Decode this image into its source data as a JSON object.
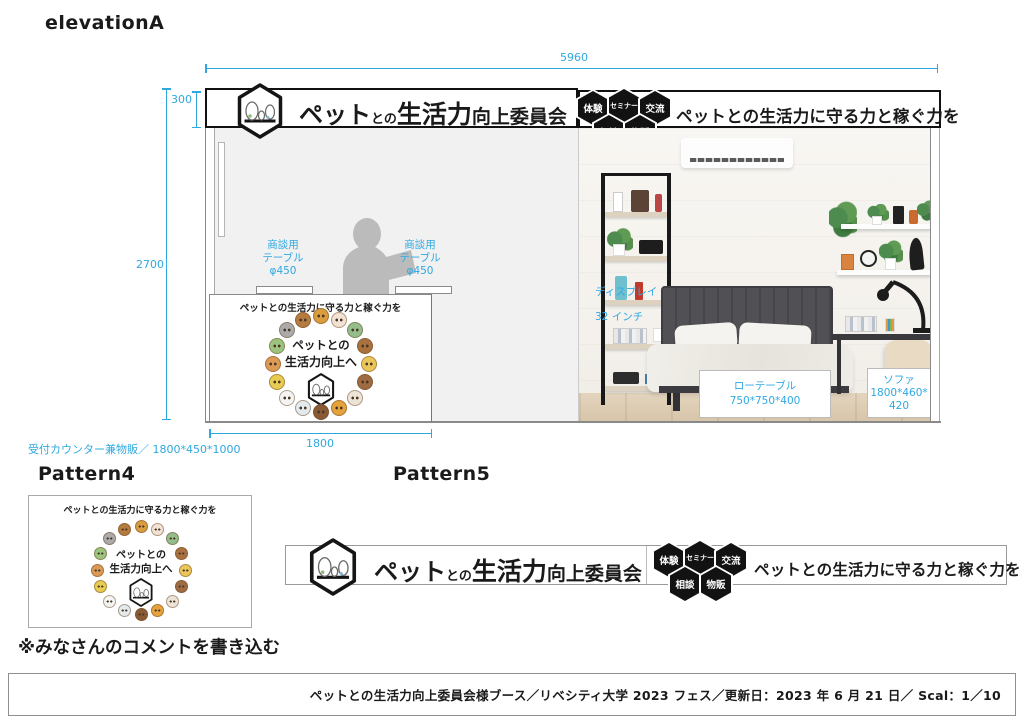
{
  "colors": {
    "dimension": "#2FA8E1",
    "wall": "#F1F1F2",
    "silhouette": "#BBBBBB",
    "badge_bg": "#121212"
  },
  "titles": {
    "elevation": "elevationA",
    "pattern4": "Pattern4",
    "pattern5": "Pattern5",
    "comment_note": "※みなさんのコメントを書き込む"
  },
  "dims": {
    "total_width": "5960",
    "total_height": "2700",
    "banner_height": "300",
    "counter_width": "1800",
    "counter_note": "受付カウンター兼物販／ 1800*450*1000"
  },
  "banner": {
    "title_1": "ペット",
    "title_2": "との",
    "title_3": "生活力",
    "title_4": "向上委員会",
    "slogan": "ペットとの生活力に守る力と稼ぐ力を",
    "badge_1": "体験",
    "badge_2": "セミナー",
    "badge_3": "交流",
    "badge_4": "相談",
    "badge_5": "物販"
  },
  "counter": {
    "slogan": "ペットとの生活力に守る力と稼ぐ力を",
    "ring_text_1": "ペットとの",
    "ring_text_2": "生活力向上へ"
  },
  "furniture": {
    "table_label_1": "商談用",
    "table_label_2": "テーブル",
    "table_label_3": "φ450",
    "display_1": "ディスプレイ",
    "display_2": "32 インチ",
    "low_table_1": "ローテーブル",
    "low_table_2": "750*750*400",
    "sofa_1": "ソファ",
    "sofa_2": "1800*460*",
    "sofa_3": "420"
  },
  "animal_ring": {
    "colors": [
      "#D99C3E",
      "#F2E1D5",
      "#93BD8B",
      "#A8713F",
      "#EBC75B",
      "#9E6B42",
      "#EDE4D8",
      "#E5A33C",
      "#8A5A36",
      "#E3EAEE",
      "#F4F4F4",
      "#E7CB52",
      "#DB9A55",
      "#9CC47E",
      "#ABABAB",
      "#B57B3F"
    ],
    "counter": {
      "radius": 48,
      "dot": 16
    },
    "pattern4": {
      "radius": 44,
      "dot": 13
    }
  },
  "footer": {
    "text": "ペットとの生活力向上委員会様ブース／リベシティ大学 2023 フェス／更新日：2023 年 6 月 21 日／ Scal：1／10"
  }
}
